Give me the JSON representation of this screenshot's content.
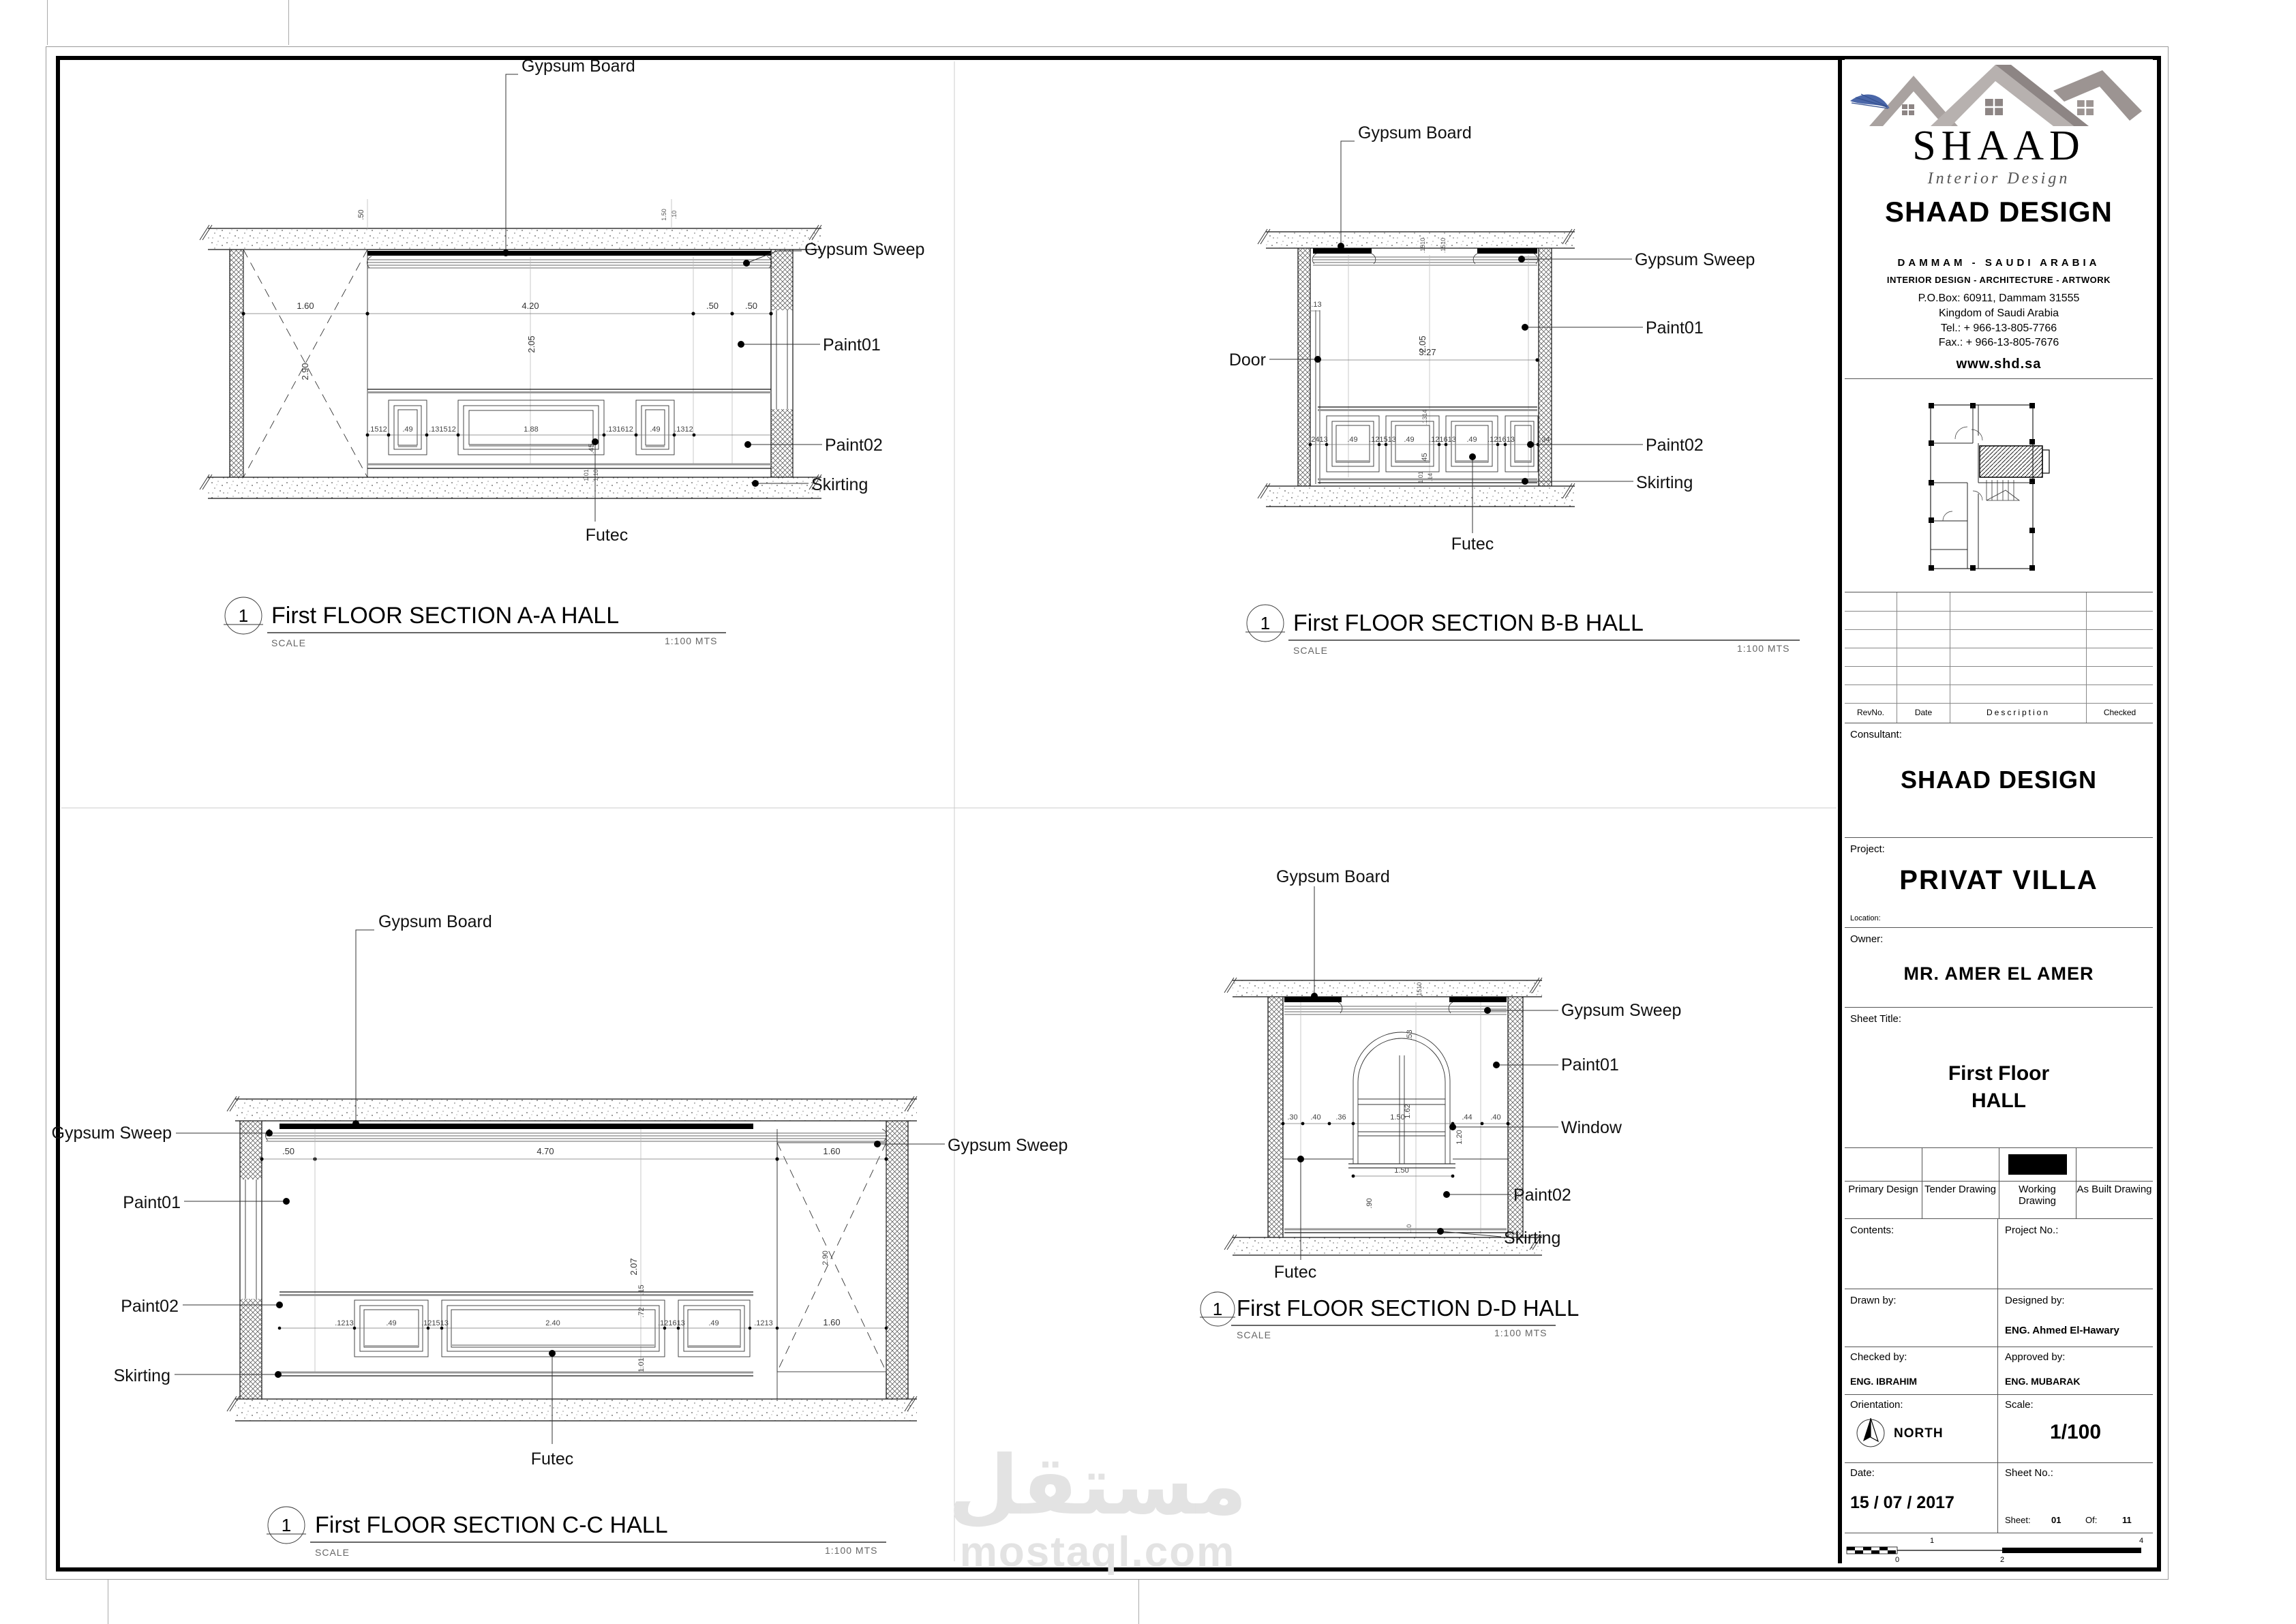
{
  "watermark": {
    "arabic": "مستقل",
    "latin": "mostaql.com"
  },
  "shared_labels": {
    "gypsum_board": "Gypsum Board",
    "gypsum_sweep": "Gypsum Sweep",
    "paint01": "Paint01",
    "paint02": "Paint02",
    "skirting": "Skirting",
    "futec": "Futec",
    "door": "Door",
    "window": "Window"
  },
  "drawings": {
    "a": {
      "num": "1",
      "title": "First FLOOR  SECTION A-A HALL",
      "scale_word": "SCALE",
      "scale_value": "1:100  MTS",
      "dims": [
        "1.60",
        "4.20",
        ".50",
        ".50",
        "2.05",
        "2.90",
        ".50",
        "1.50",
        ".10",
        ".1512",
        ".49",
        ".131512",
        "1.88",
        ".131612",
        ".49",
        ".1312",
        ".45",
        "1.01",
        "1.10"
      ]
    },
    "b": {
      "num": "1",
      "title": "First FLOOR  SECTION B-B HALL",
      "scale_word": "SCALE",
      "scale_value": "1:100  MTS",
      "dims": [
        ".13",
        "2.05",
        "3.27",
        ".1510",
        ".1510",
        ".2413",
        ".49",
        ".121513",
        ".49",
        ".121613",
        ".49",
        ".121613",
        ".34",
        ".1314",
        ".45",
        "1.01",
        ".14"
      ]
    },
    "c": {
      "num": "1",
      "title": "First FLOOR  SECTION C-C HALL",
      "scale_word": "SCALE",
      "scale_value": "1:100  MTS",
      "dims": [
        ".50",
        "4.70",
        "1.60",
        "2.07",
        "2.90",
        ".1213",
        ".49",
        ".121513",
        "2.40",
        ".121613",
        ".49",
        ".1213",
        "1.60",
        ".15",
        ".72",
        "1.01"
      ]
    },
    "d": {
      "num": "1",
      "title": "First FLOOR  SECTION D-D HALL",
      "scale_word": "SCALE",
      "scale_value": "1:100  MTS",
      "dims": [
        ".30",
        ".40",
        ".36",
        "1.50",
        ".44",
        ".40",
        ".53",
        "1.62",
        "1.20",
        "1.50",
        ".90",
        ".10",
        ".1510"
      ]
    }
  },
  "titleblock": {
    "brand": "SHAAD",
    "brand_sub": "Interior Design",
    "company": "SHAAD DESIGN",
    "city": "DAMMAM - SAUDI ARABIA",
    "services": "INTERIOR DESIGN - ARCHITECTURE - ARTWORK",
    "pobox": "P.O.Box: 60911, Dammam 31555",
    "kingdom": "Kingdom of Saudi Arabia",
    "tel": "Tel.: + 966-13-805-7766",
    "fax": "Fax.: + 966-13-805-7676",
    "website": "www.shd.sa",
    "rev": {
      "no": "RevNo.",
      "date": "Date",
      "desc": "Description",
      "checked": "Checked"
    },
    "consultant_label": "Consultant:",
    "consultant_name": "SHAAD DESIGN",
    "project_label": "Project:",
    "project_name": "PRIVAT VILLA",
    "location_label": "Location:",
    "owner_label": "Owner:",
    "owner_name": "MR. AMER EL AMER",
    "sheet_title_label": "Sheet Title:",
    "sheet_title_line1": "First Floor",
    "sheet_title_line2": "HALL",
    "types": [
      "Primary Design",
      "Tender Drawing",
      "Working Drawing",
      "As Built Drawing"
    ],
    "contents_label": "Contents:",
    "project_no_label": "Project No.:",
    "drawn_label": "Drawn by:",
    "designed_label": "Designed by:",
    "designed_name": "ENG. Ahmed El-Hawary",
    "checked_label": "Checked by:",
    "checked_name": "ENG. IBRAHIM",
    "approved_label": "Approved by:",
    "approved_name": "ENG. MUBARAK",
    "orientation_label": "Orientation:",
    "north_label": "NORTH",
    "scale_label": "Scale:",
    "scale_value": "1/100",
    "date_label": "Date:",
    "date_value": "15 / 07 / 2017",
    "sheet_no_label": "Sheet No.:",
    "sheet_word": "Sheet:",
    "sheet_value": "01",
    "of_word": "Of:",
    "of_value": "11",
    "scalebar": [
      "0",
      "1",
      "2",
      "4"
    ]
  }
}
